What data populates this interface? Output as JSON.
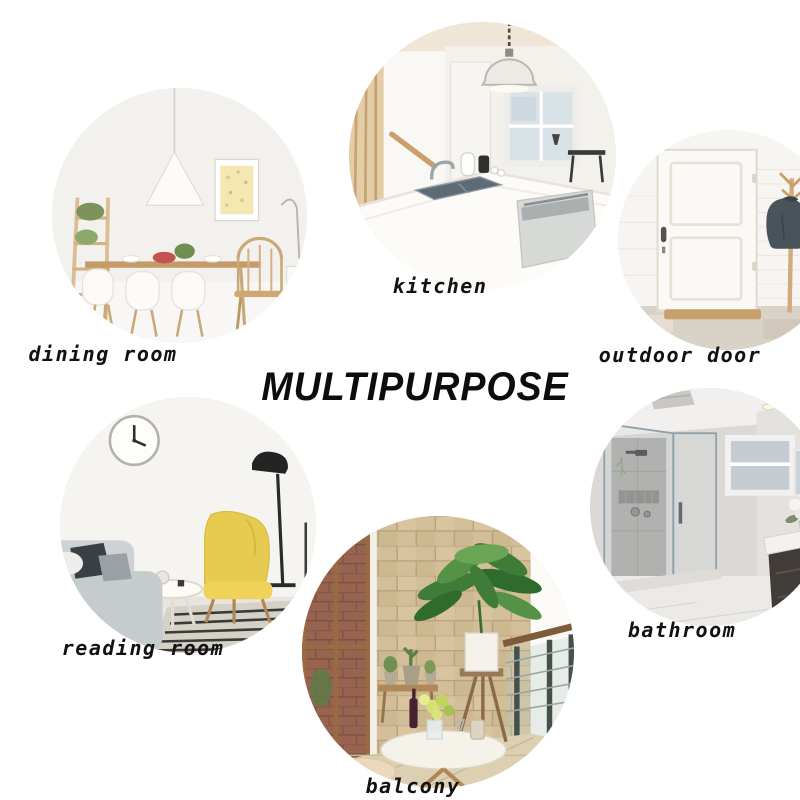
{
  "title": "MULTIPURPOSE",
  "rooms": [
    {
      "label": "dining room",
      "alt": "bright dining room with white shell chairs, wooden table, pendant lamp, ladder shelf and framed art"
    },
    {
      "label": "kitchen",
      "alt": "white kitchen island with sink and faucet, pendant dome lamp, window and dishwasher"
    },
    {
      "label": "outdoor door",
      "alt": "white paneled entry door with doormat and wooden coat rack holding a dark jacket"
    },
    {
      "label": "reading room",
      "alt": "living corner with wall clock, yellow wingback chair, grey sofa, round table and black floor lamp"
    },
    {
      "label": "bathroom",
      "alt": "glass walk-in shower with grey tile, window, marble floor and dark vanity with flowers"
    },
    {
      "label": "balcony",
      "alt": "stone-wall balcony with tall potted plant, glass railing, round white table with flowers and stools"
    }
  ],
  "colors": {
    "background": "#ffffff",
    "text": "#121212",
    "wood_accent": "#c59a69",
    "plant_green": "#3e7c38"
  }
}
